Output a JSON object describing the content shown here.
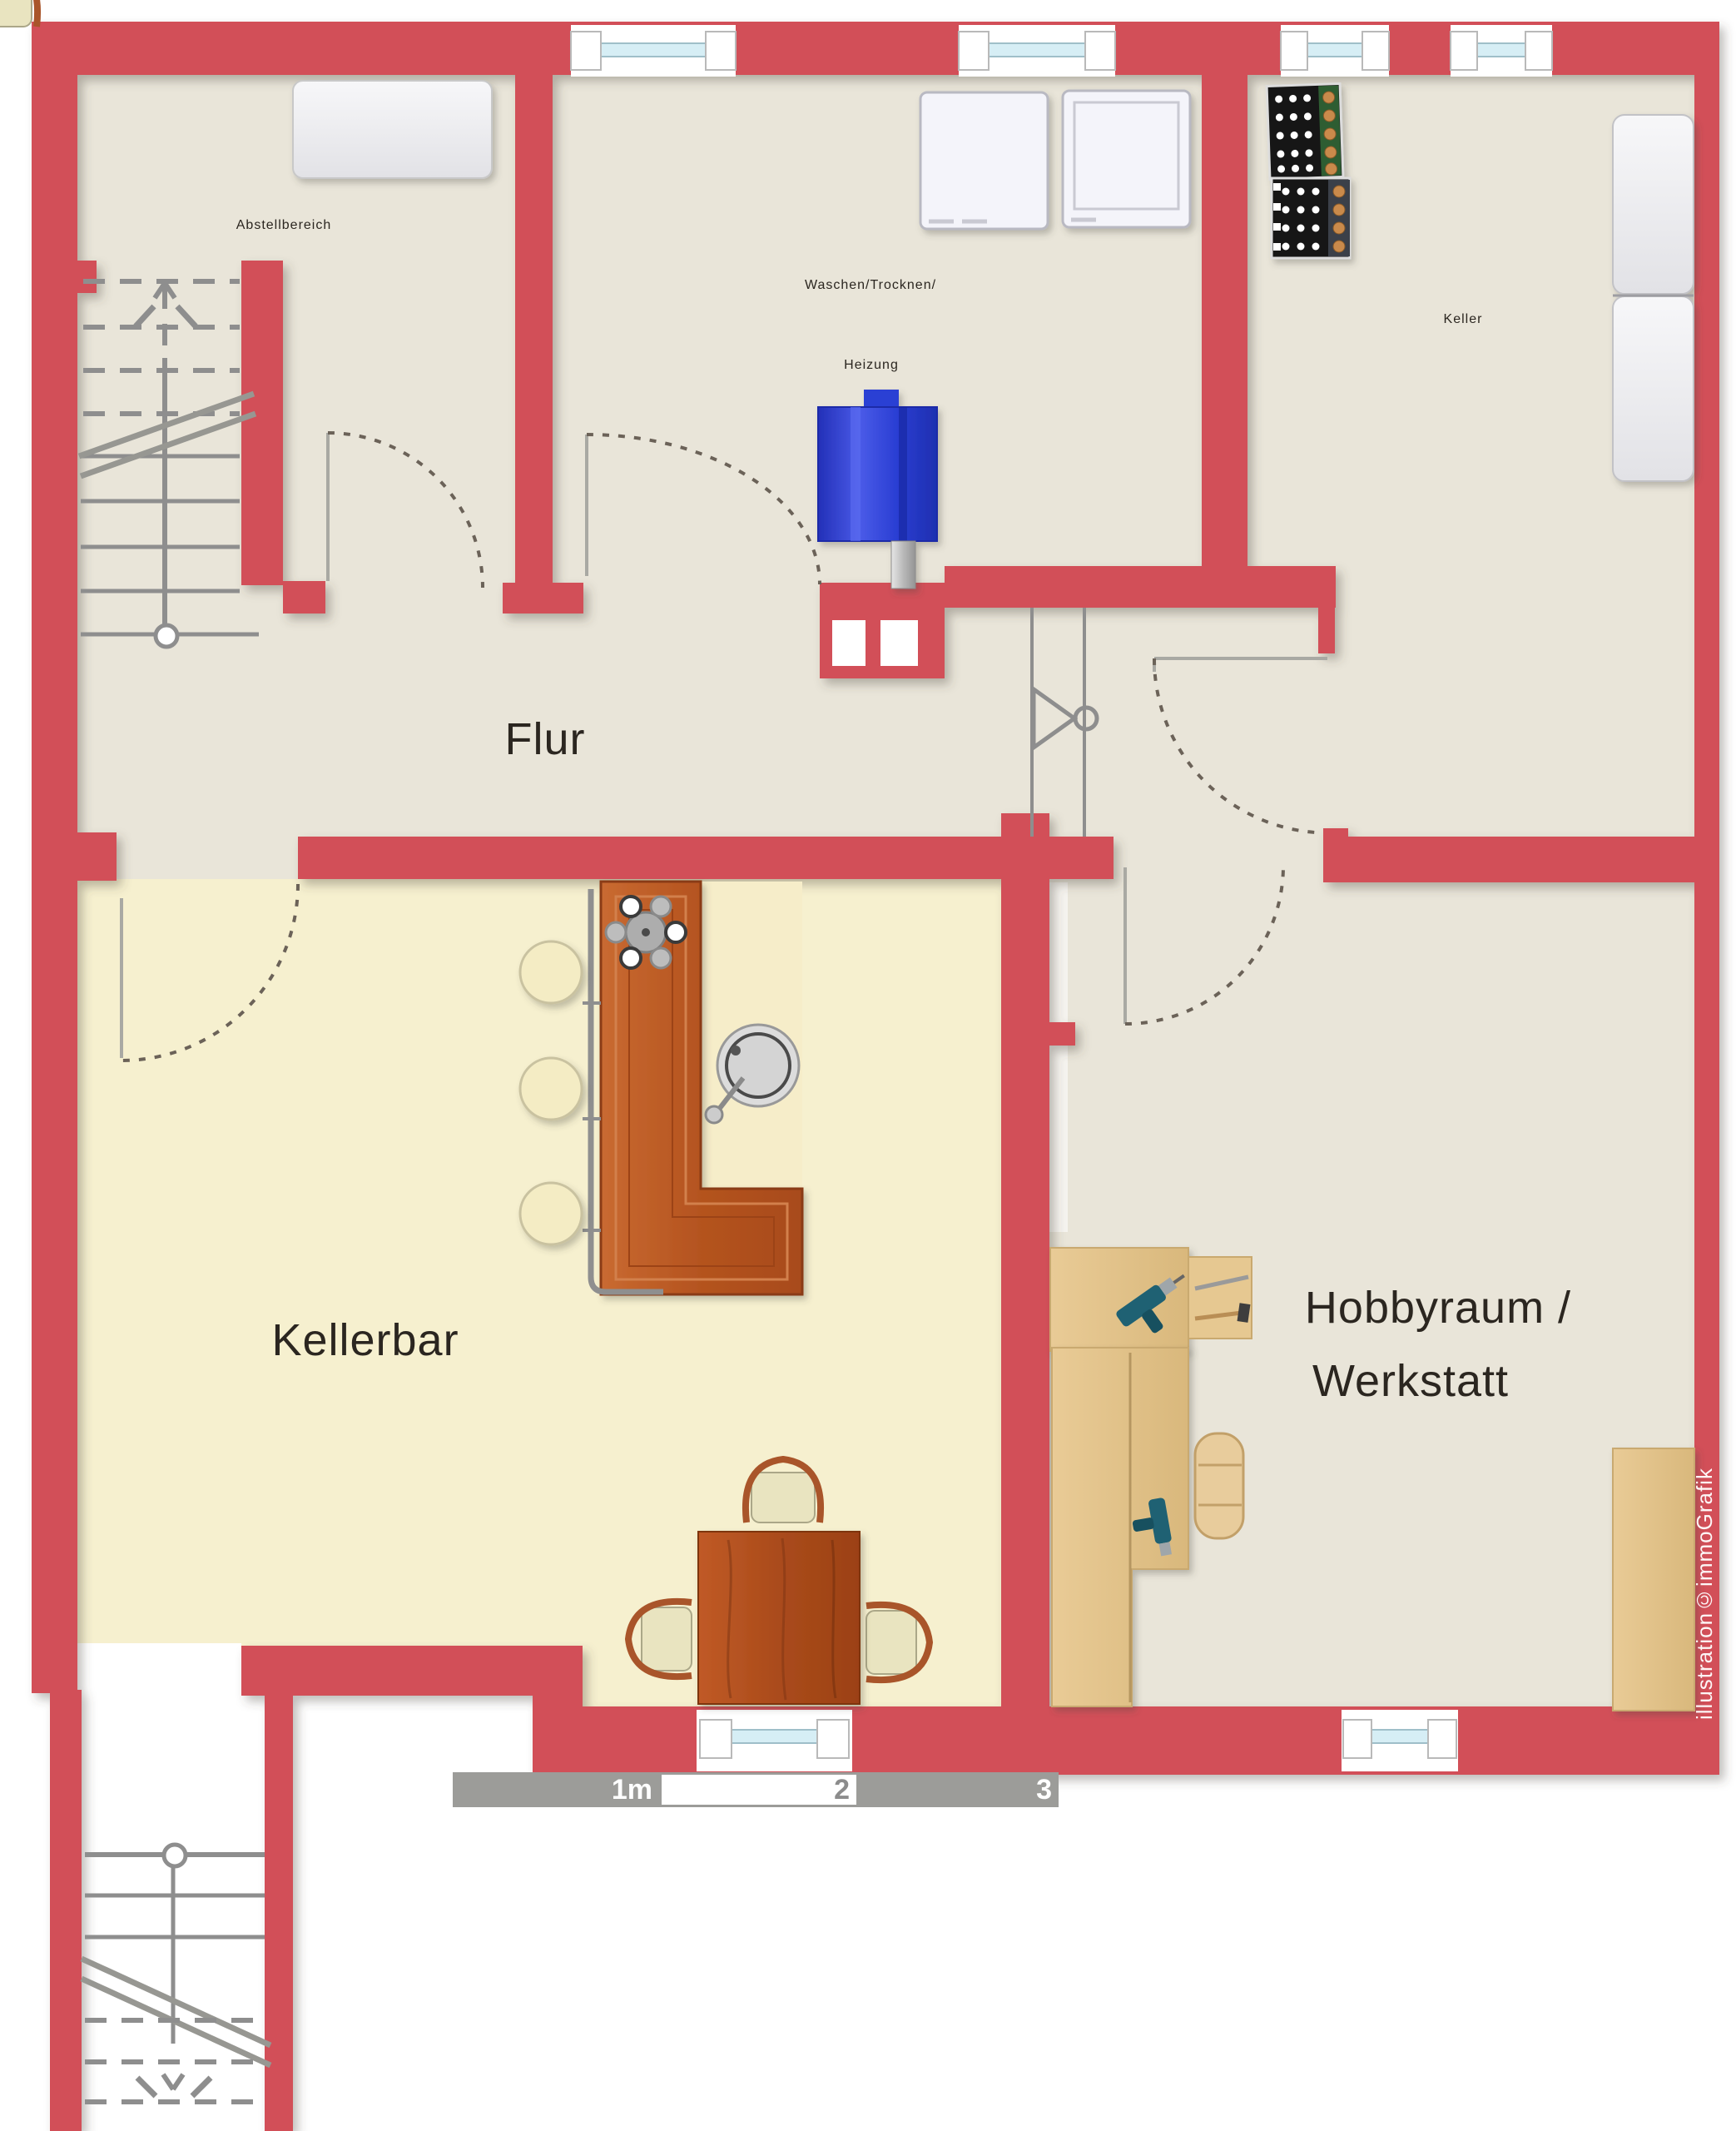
{
  "rooms": {
    "abstellbereich": {
      "label": "Abstellbereich"
    },
    "waschen": {
      "line1": "Waschen/Trocknen/",
      "line2": "Heizung"
    },
    "keller": {
      "label": "Keller"
    },
    "flur": {
      "label": "Flur"
    },
    "kellerbar": {
      "label": "Kellerbar"
    },
    "hobbyraum": {
      "line1": "Hobbyraum /",
      "line2": "Werkstatt"
    }
  },
  "scale_bar": {
    "labels": [
      "1m",
      "2",
      "3"
    ]
  },
  "watermark": {
    "text": "illustration©immoGrafik"
  },
  "colors": {
    "wall_red": "#d25059",
    "floor_beige": "#e9e5d9",
    "kellerbar_floor": "#f6f0cf",
    "bar_wood": "#b4531f",
    "bench_wood": "#e2c08c",
    "boiler_blue": "#2b3fd4",
    "window_glazing": "#d6eef5",
    "line_gray": "#8e8e8e",
    "label_text": "#2b2620",
    "scalebar_gray": "#9c9c99"
  },
  "objects": [
    "stairs-up-symbol",
    "stairs-down-symbol",
    "washing-machine-symbol",
    "dryer-symbol",
    "boiler-symbol",
    "wine-rack-symbol",
    "freezer-symbol",
    "cabinet-symbol",
    "bar-counter-symbol",
    "bar-stool-symbol",
    "sink-symbol",
    "grapes-symbol",
    "bar-table-symbol",
    "chair-symbol",
    "workbench-symbol",
    "drill-symbol",
    "door-swing-symbol",
    "window-symbol",
    "valve-symbol"
  ]
}
